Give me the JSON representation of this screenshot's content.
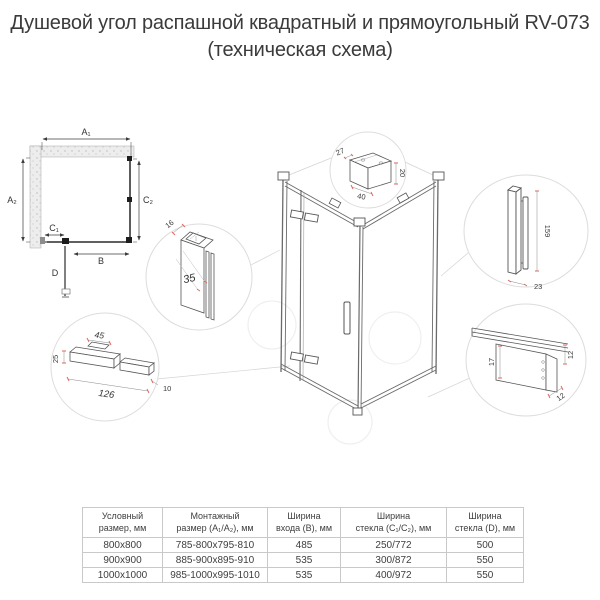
{
  "title": {
    "line1": "Душевой угол распашной квадратный и прямоугольный RV-073",
    "line2": "(техническая схема)"
  },
  "colors": {
    "line": "#4a4a4a",
    "circle": "#dcdcdc",
    "accent_red": "#d96a5f"
  },
  "plan": {
    "labels": {
      "a1": "A₁",
      "a2": "A₂",
      "c1": "C₁",
      "c2": "C₂",
      "b": "B",
      "d": "D"
    }
  },
  "details": {
    "bracket": {
      "depth": "27",
      "height": "20",
      "width": "40"
    },
    "wall_profile": {
      "thickness": "16",
      "adjustment": "35"
    },
    "handle": {
      "height": "159",
      "depth": "23"
    },
    "hinge": {
      "plate_width": "45",
      "height": "25",
      "length": "126",
      "depth": "10"
    },
    "bottom_profile": {
      "glass_height": "17",
      "height": "12",
      "depth": "12"
    }
  },
  "table": {
    "headers": [
      "Условный\nразмер, мм",
      "Монтажный\nразмер (А₁/А₂), мм",
      "Ширина\nвхода (В), мм",
      "Ширина\nстекла (С₁/С₂), мм",
      "Ширина\nстекла (D), мм"
    ],
    "rows": [
      [
        "800x800",
        "785-800x795-810",
        "485",
        "250/772",
        "500"
      ],
      [
        "900x900",
        "885-900x895-910",
        "535",
        "300/872",
        "550"
      ],
      [
        "1000x1000",
        "985-1000x995-1010",
        "535",
        "400/972",
        "550"
      ]
    ]
  }
}
